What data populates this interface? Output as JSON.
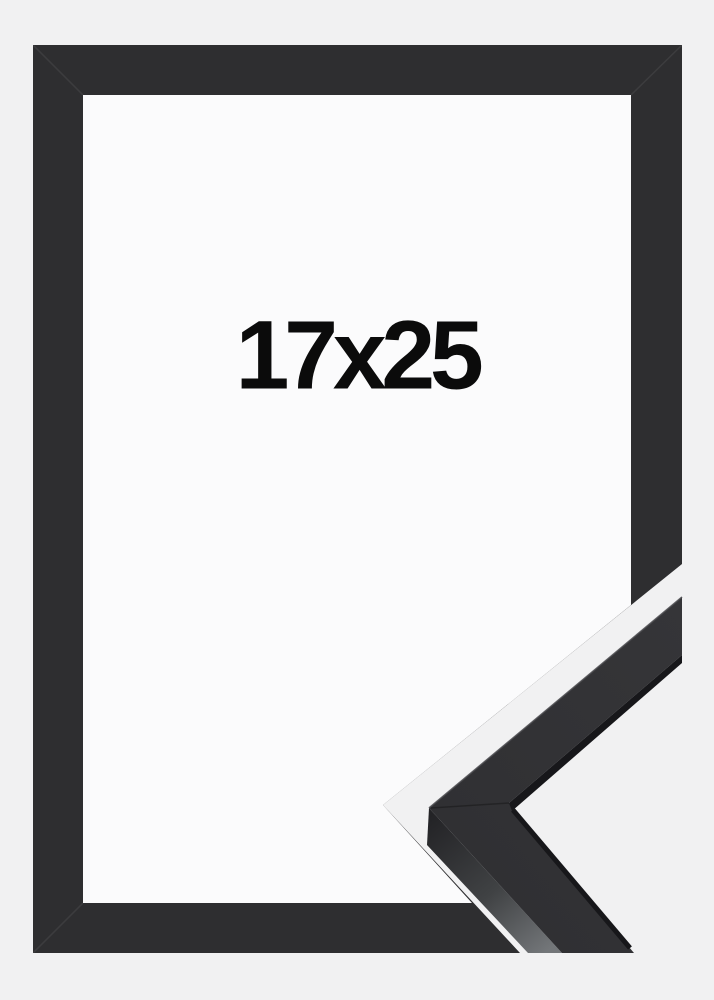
{
  "product_image": {
    "size_label": "17x25",
    "subject": "black picture frame with mitered corner sample detail"
  },
  "colors": {
    "background": "#f1f1f2",
    "opening": "#fbfbfc",
    "frame": "#2e2e30",
    "frame_triangle": "#2c2c2e",
    "sample_face": "#353538",
    "sample_face_deep": "#303033",
    "edge_shadow": "#17171a",
    "side_dark": "#232326",
    "side_mid": "#404244",
    "side_light": "#737679",
    "rim_highlight": "#4a4a4e",
    "label_text": "#0b0b0b"
  }
}
